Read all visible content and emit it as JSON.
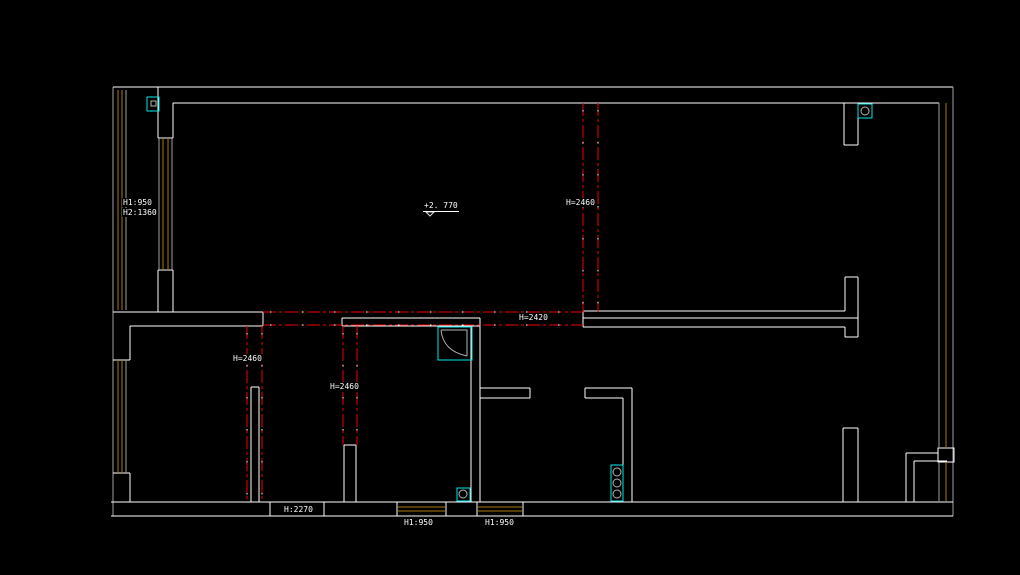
{
  "drawing": {
    "kind": "cad-floor-plan",
    "background": "#000000"
  },
  "colors": {
    "wall": "#ffffff",
    "muted_wall": "#9f9f9f",
    "window_frame": "#a87908",
    "beam_line": "#f20000",
    "fixture": "#00e8e8",
    "label_text": "#ffffff"
  },
  "labels": {
    "bay_h1": "H1:950",
    "bay_h2": "H2:1360",
    "level_mark": "+2. 770",
    "beam_living": "H=2460",
    "beam_opening": "H=2420",
    "beam_bedroom": "H=2460",
    "beam_mid_room": "H=2460",
    "bottom_wall_height": "H:2270",
    "bottom_window_1": "H1:950",
    "bottom_window_2": "H1:950"
  },
  "fixtures": [
    "symbol-box-top-left",
    "symbol-circle-top-right",
    "corner-tub-symbol",
    "floor-drain-symbol",
    "riser-stack-symbol"
  ]
}
